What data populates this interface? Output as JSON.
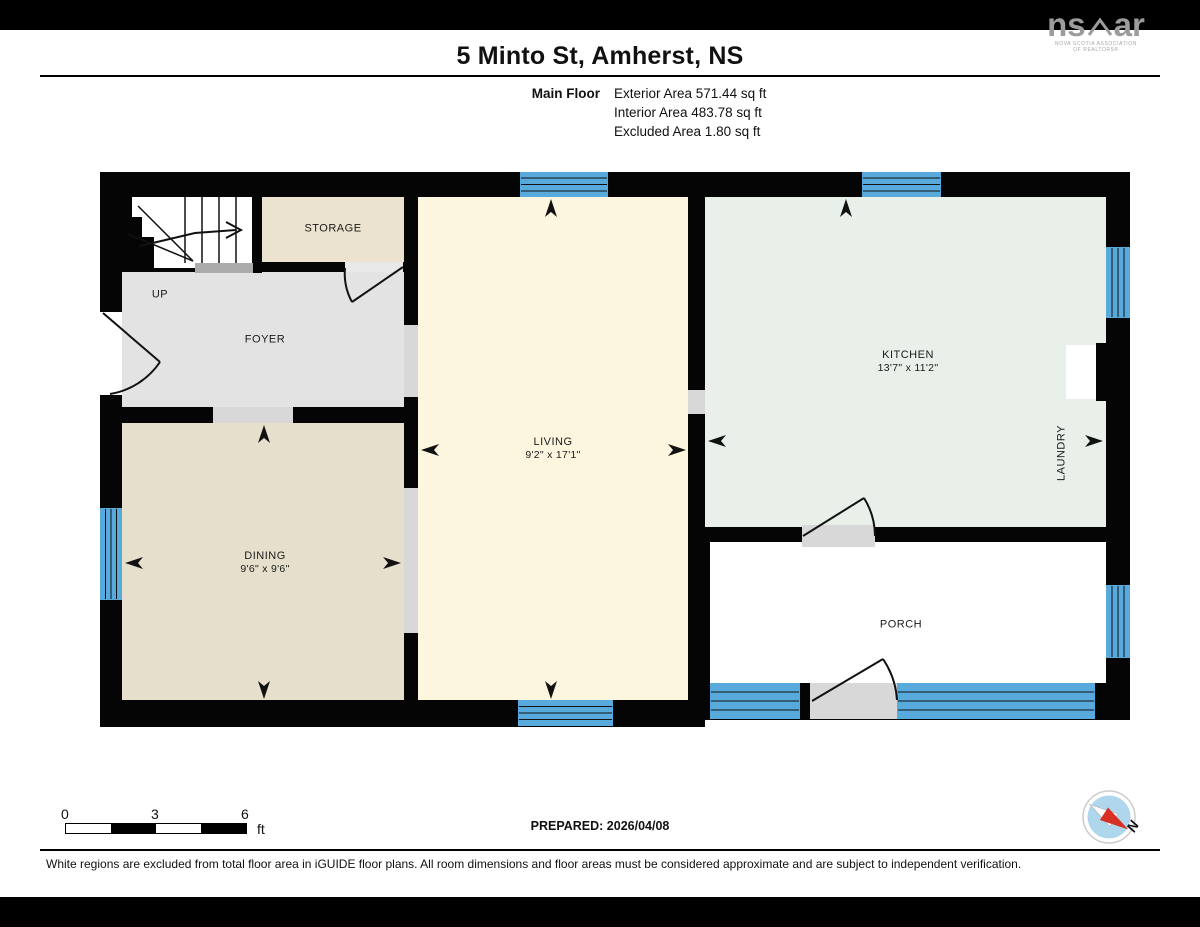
{
  "header": {
    "title": "5 Minto St, Amherst, NS",
    "floor_label": "Main Floor",
    "stats": [
      "Exterior Area 571.44 sq ft",
      "Interior Area 483.78 sq ft",
      "Excluded Area 1.80 sq ft"
    ]
  },
  "logo": {
    "mark_left": "ns",
    "mark_right": "ar",
    "sub1": "NOVA SCOTIA ASSOCIATION",
    "sub2": "OF REALTORS®"
  },
  "plan": {
    "rooms": {
      "storage": {
        "label": "STORAGE"
      },
      "foyer": {
        "label": "FOYER"
      },
      "up": {
        "label": "UP"
      },
      "living": {
        "label": "LIVING",
        "dims": "9'2\" x 17'1\""
      },
      "kitchen": {
        "label": "KITCHEN",
        "dims": "13'7\" x 11'2\""
      },
      "dining": {
        "label": "DINING",
        "dims": "9'6\" x 9'6\""
      },
      "laundry": {
        "label": "LAUNDRY"
      },
      "porch": {
        "label": "PORCH"
      }
    }
  },
  "footer": {
    "scale": {
      "labels": [
        "0",
        "3",
        "6"
      ],
      "unit": "ft"
    },
    "prepared": "PREPARED: 2026/04/08",
    "compass_n": "N",
    "disclaimer": "White regions are excluded from total floor area in iGUIDE floor plans. All room dimensions and floor areas must be considered approximate and are subject to independent verification."
  },
  "colors": {
    "wall": "#050505",
    "window_blue": "#58aadd",
    "living": "#fdf6de",
    "kitchen": "#e8f0e9",
    "dining": "#e6dfcc",
    "storage": "#ebe2cf",
    "foyer": "#e3e3e3",
    "opening_gray": "#d8d8d8",
    "excluded_white": "#ffffff",
    "compass_red": "#d93025",
    "compass_blue": "#aed7ee"
  }
}
